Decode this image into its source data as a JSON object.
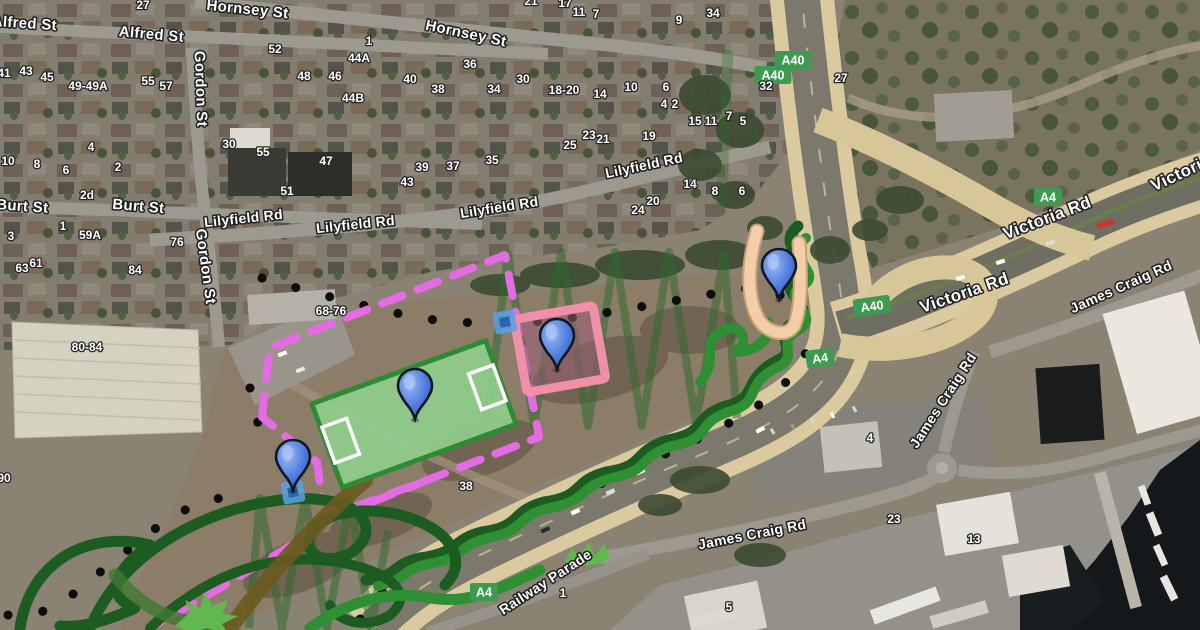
{
  "map": {
    "view_type": "satellite",
    "street_labels": [
      {
        "text": "Hornsey St",
        "x": 247,
        "y": 14,
        "rot": 6,
        "size": 15
      },
      {
        "text": "Hornsey St",
        "x": 465,
        "y": 38,
        "rot": 12,
        "size": 15
      },
      {
        "text": "Alfred St",
        "x": 24,
        "y": 28,
        "rot": 4,
        "size": 15
      },
      {
        "text": "Alfred St",
        "x": 151,
        "y": 39,
        "rot": 5,
        "size": 15
      },
      {
        "text": "Gordon St",
        "x": 196,
        "y": 89,
        "rot": 88,
        "size": 15
      },
      {
        "text": "Gordon St",
        "x": 201,
        "y": 267,
        "rot": 82,
        "size": 15
      },
      {
        "text": "Burt St",
        "x": 22,
        "y": 211,
        "rot": 4,
        "size": 15
      },
      {
        "text": "Burt St",
        "x": 138,
        "y": 211,
        "rot": 5,
        "size": 15
      },
      {
        "text": "Lilyfield Rd",
        "x": 244,
        "y": 223,
        "rot": -6,
        "size": 14
      },
      {
        "text": "Lilyfield Rd",
        "x": 356,
        "y": 229,
        "rot": -6,
        "size": 14
      },
      {
        "text": "Lilyfield Rd",
        "x": 500,
        "y": 212,
        "rot": -9,
        "size": 14
      },
      {
        "text": "Lilyfield Rd",
        "x": 645,
        "y": 170,
        "rot": -12,
        "size": 14
      },
      {
        "text": "Victoria Rd",
        "x": 966,
        "y": 298,
        "rot": -19,
        "size": 17
      },
      {
        "text": "Victoria Rd",
        "x": 1049,
        "y": 223,
        "rot": -21,
        "size": 17
      },
      {
        "text": "Victoria Rd",
        "x": 1196,
        "y": 172,
        "rot": -25,
        "size": 17
      },
      {
        "text": "James Craig Rd",
        "x": 947,
        "y": 403,
        "rot": -57,
        "size": 14
      },
      {
        "text": "James Craig Rd",
        "x": 1123,
        "y": 291,
        "rot": -24,
        "size": 14
      },
      {
        "text": "James Craig Rd",
        "x": 753,
        "y": 539,
        "rot": -11,
        "size": 14
      },
      {
        "text": "Railway Parade",
        "x": 548,
        "y": 586,
        "rot": -33,
        "size": 14
      }
    ],
    "house_numbers": [
      {
        "text": "27",
        "x": 143,
        "y": 9
      },
      {
        "text": "41",
        "x": 4,
        "y": 77
      },
      {
        "text": "43",
        "x": 26,
        "y": 75
      },
      {
        "text": "45",
        "x": 47,
        "y": 81
      },
      {
        "text": "49-49A",
        "x": 88,
        "y": 90
      },
      {
        "text": "55",
        "x": 148,
        "y": 85
      },
      {
        "text": "57",
        "x": 166,
        "y": 90
      },
      {
        "text": "1",
        "x": 369,
        "y": 45
      },
      {
        "text": "52",
        "x": 275,
        "y": 53
      },
      {
        "text": "48",
        "x": 304,
        "y": 80
      },
      {
        "text": "46",
        "x": 335,
        "y": 80
      },
      {
        "text": "44A",
        "x": 359,
        "y": 62
      },
      {
        "text": "44B",
        "x": 353,
        "y": 102
      },
      {
        "text": "30",
        "x": 229,
        "y": 148
      },
      {
        "text": "55",
        "x": 263,
        "y": 156
      },
      {
        "text": "47",
        "x": 326,
        "y": 165
      },
      {
        "text": "51",
        "x": 287,
        "y": 195
      },
      {
        "text": "10",
        "x": 8,
        "y": 165
      },
      {
        "text": "8",
        "x": 37,
        "y": 168
      },
      {
        "text": "6",
        "x": 66,
        "y": 174
      },
      {
        "text": "4",
        "x": 91,
        "y": 151
      },
      {
        "text": "2",
        "x": 118,
        "y": 171
      },
      {
        "text": "2d",
        "x": 87,
        "y": 199
      },
      {
        "text": "1",
        "x": 63,
        "y": 230
      },
      {
        "text": "3",
        "x": 11,
        "y": 240
      },
      {
        "text": "59A",
        "x": 90,
        "y": 239
      },
      {
        "text": "63",
        "x": 22,
        "y": 272
      },
      {
        "text": "61",
        "x": 36,
        "y": 267
      },
      {
        "text": "36",
        "x": 470,
        "y": 68
      },
      {
        "text": "40",
        "x": 410,
        "y": 83
      },
      {
        "text": "38",
        "x": 438,
        "y": 93
      },
      {
        "text": "34",
        "x": 494,
        "y": 93
      },
      {
        "text": "30",
        "x": 523,
        "y": 83
      },
      {
        "text": "18-20",
        "x": 564,
        "y": 94
      },
      {
        "text": "14",
        "x": 600,
        "y": 98
      },
      {
        "text": "10",
        "x": 631,
        "y": 91
      },
      {
        "text": "6",
        "x": 666,
        "y": 91
      },
      {
        "text": "4",
        "x": 664,
        "y": 108
      },
      {
        "text": "2",
        "x": 675,
        "y": 108
      },
      {
        "text": "15",
        "x": 695,
        "y": 125
      },
      {
        "text": "11",
        "x": 711,
        "y": 125
      },
      {
        "text": "7",
        "x": 729,
        "y": 120
      },
      {
        "text": "5",
        "x": 743,
        "y": 125
      },
      {
        "text": "21",
        "x": 531,
        "y": 5
      },
      {
        "text": "17",
        "x": 565,
        "y": 7
      },
      {
        "text": "11",
        "x": 579,
        "y": 16
      },
      {
        "text": "7",
        "x": 596,
        "y": 18
      },
      {
        "text": "9",
        "x": 679,
        "y": 24
      },
      {
        "text": "34",
        "x": 713,
        "y": 17
      },
      {
        "text": "27",
        "x": 841,
        "y": 82
      },
      {
        "text": "32",
        "x": 766,
        "y": 90
      },
      {
        "text": "25",
        "x": 570,
        "y": 149
      },
      {
        "text": "23",
        "x": 589,
        "y": 139
      },
      {
        "text": "21",
        "x": 603,
        "y": 143
      },
      {
        "text": "19",
        "x": 649,
        "y": 140
      },
      {
        "text": "35",
        "x": 492,
        "y": 164
      },
      {
        "text": "39",
        "x": 422,
        "y": 171
      },
      {
        "text": "37",
        "x": 453,
        "y": 170
      },
      {
        "text": "43",
        "x": 407,
        "y": 186
      },
      {
        "text": "14",
        "x": 690,
        "y": 188
      },
      {
        "text": "8",
        "x": 715,
        "y": 195
      },
      {
        "text": "6",
        "x": 742,
        "y": 195
      },
      {
        "text": "24",
        "x": 638,
        "y": 214
      },
      {
        "text": "20",
        "x": 653,
        "y": 205
      },
      {
        "text": "76",
        "x": 177,
        "y": 246
      },
      {
        "text": "84",
        "x": 135,
        "y": 274
      },
      {
        "text": "68-76",
        "x": 331,
        "y": 315
      },
      {
        "text": "80-84",
        "x": 87,
        "y": 351
      },
      {
        "text": "38",
        "x": 466,
        "y": 490
      },
      {
        "text": "4",
        "x": 870,
        "y": 442
      },
      {
        "text": "23",
        "x": 894,
        "y": 523
      },
      {
        "text": "13",
        "x": 974,
        "y": 543
      },
      {
        "text": "1",
        "x": 563,
        "y": 597
      },
      {
        "text": "5",
        "x": 729,
        "y": 611
      },
      {
        "text": "90",
        "x": 4,
        "y": 482
      }
    ],
    "route_badges": [
      {
        "text": "A40",
        "x": 793,
        "y": 60,
        "rot": 0
      },
      {
        "text": "A40",
        "x": 773,
        "y": 75,
        "rot": 0
      },
      {
        "text": "A40",
        "x": 872,
        "y": 306,
        "rot": -8
      },
      {
        "text": "A4",
        "x": 1048,
        "y": 197,
        "rot": 0
      },
      {
        "text": "A4",
        "x": 820,
        "y": 358,
        "rot": -8
      },
      {
        "text": "A4",
        "x": 484,
        "y": 592,
        "rot": 0
      }
    ],
    "markers": [
      {
        "x": 415,
        "y": 419
      },
      {
        "x": 557,
        "y": 369
      },
      {
        "x": 779,
        "y": 299
      },
      {
        "x": 293,
        "y": 490
      }
    ],
    "waypoint_squares": [
      {
        "x": 505,
        "y": 322
      },
      {
        "x": 293,
        "y": 492
      }
    ],
    "colors": {
      "badge": "#3e9a51",
      "pin_blue": "#4f7ce0",
      "boundary_magenta": "#e46be4",
      "field_fill": "#8fcf8d",
      "field_border": "#2f8b33",
      "pink_border": "#ef8fa8",
      "scribble_dark": "#1d5c20",
      "scribble_mid": "#2f8f33",
      "splat_green": "#62b84e",
      "peach_path": "#f4cda9",
      "zigzag": "#2d6b2d",
      "square_blue": "#5aa0e6",
      "dotted": "#0d0d0d"
    }
  }
}
